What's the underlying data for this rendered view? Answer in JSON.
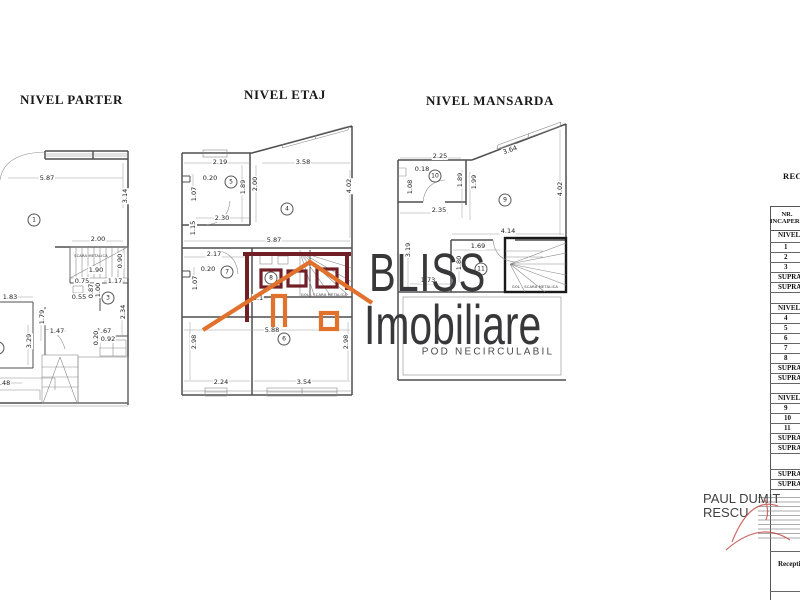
{
  "plans": {
    "parter": {
      "title": "NIVEL PARTER",
      "stair_label": "SCARA METALICA",
      "rooms": [
        "1",
        "2",
        "3"
      ],
      "dims": [
        "5.87",
        "3.14",
        "2.00",
        "1.90",
        "0.90",
        "0.75",
        "1.17",
        "0.55",
        "0.87",
        "1.00",
        "2.34",
        "1.83",
        "1.79",
        "3.29",
        "1.47",
        "1.67",
        "0.20",
        "0.92",
        "2.48"
      ]
    },
    "etaj": {
      "title": "NIVEL ETAJ",
      "stair_label": "GOL - SCARA METALICA",
      "rooms": [
        "5",
        "4",
        "7",
        "8",
        "6"
      ],
      "dims": [
        "2.19",
        "3.58",
        "0.20",
        "1.07",
        "1.89",
        "2.00",
        "4.02",
        "2.30",
        "1.15",
        "5.87",
        "2.17",
        "0.20",
        "1.07",
        "1.1",
        "5.88",
        "2.98",
        "2.98",
        "2.24",
        "3.54"
      ]
    },
    "mansarda": {
      "title": "NIVEL MANSARDA",
      "stair_label": "GOL - SCARA METALICA",
      "pod_label": "POD NECIRCULABIL",
      "rooms": [
        "10",
        "9",
        "11"
      ],
      "dims": [
        "3.64",
        "2.25",
        "0.18",
        "1.08",
        "1.89",
        "1.99",
        "4.02",
        "2.35",
        "4.14",
        "1.69",
        "1.80",
        "1.73",
        "3.19"
      ]
    }
  },
  "watermark": {
    "line1": "BLISS",
    "line2": "Imobiliare",
    "text_color": "#38383a",
    "orange": "#e0722e",
    "maroon": "#701f26"
  },
  "side_table": {
    "title": "RECAPITULATIE",
    "header_line1": "NR.",
    "header_line2": "INCAPERE",
    "rows": [
      "NIVEL PARTER",
      "1",
      "2",
      "3",
      "SUPRAFATA",
      "SUPRAFATA",
      "NIVEL ETAJ",
      "4",
      "5",
      "6",
      "7",
      "8",
      "SUPRAFATA",
      "SUPRAFATA",
      "NIVEL MANSARDA",
      "9",
      "10",
      "11",
      "SUPRAFATA",
      "SUPRAFATA"
    ],
    "total_rows": [
      "SUPRAFATA",
      "SUPRAFATA"
    ],
    "reception_label": "Receptionat"
  },
  "signature": {
    "name": "PAUL DUMITRESCU"
  }
}
